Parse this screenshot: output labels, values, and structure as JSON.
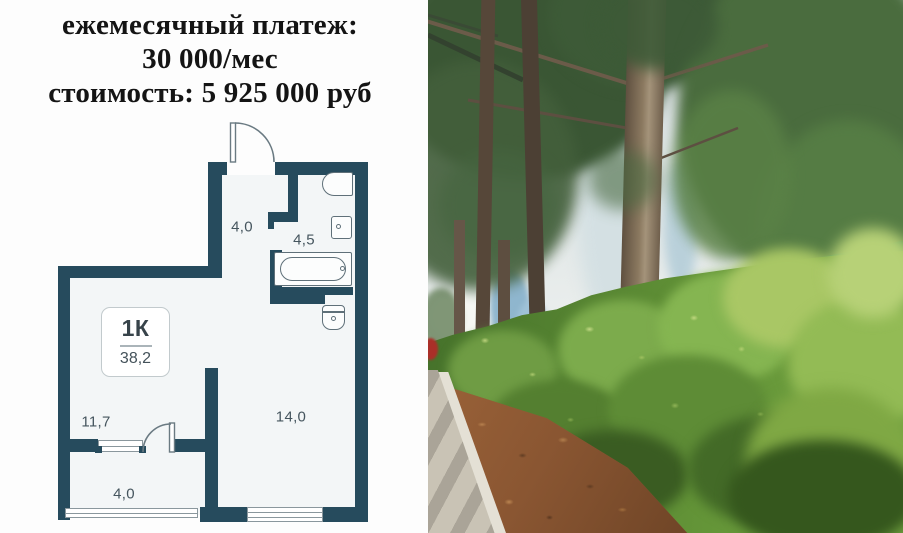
{
  "header": {
    "line1": "ежемесячный платеж:",
    "line2": "30 000/мес",
    "line3": "стоимость: 5 925 000 руб"
  },
  "floor_plan": {
    "unit_label": "1К",
    "total_area": "38,2",
    "rooms": [
      {
        "name": "hallway",
        "area": "4,0"
      },
      {
        "name": "bathroom",
        "area": "4,5"
      },
      {
        "name": "kitchen",
        "area": "11,7"
      },
      {
        "name": "living-room",
        "area": "14,0"
      },
      {
        "name": "balcony",
        "area": "4,0"
      }
    ],
    "colors": {
      "wall": "#264b5d",
      "floor": "#f3f6f7",
      "fixture_outline": "#5f7079",
      "label_text": "#45555e"
    }
  },
  "photo": {
    "colors": {
      "foliage_dark": "#3a5634",
      "foliage_bright": "#6f9f3f",
      "trunk": "#8b7960",
      "mulch": "#905c36",
      "sidewalk": "#c9c3b5",
      "awning_green": "#3f8350",
      "sky_blue": "#9fc0d6"
    }
  }
}
